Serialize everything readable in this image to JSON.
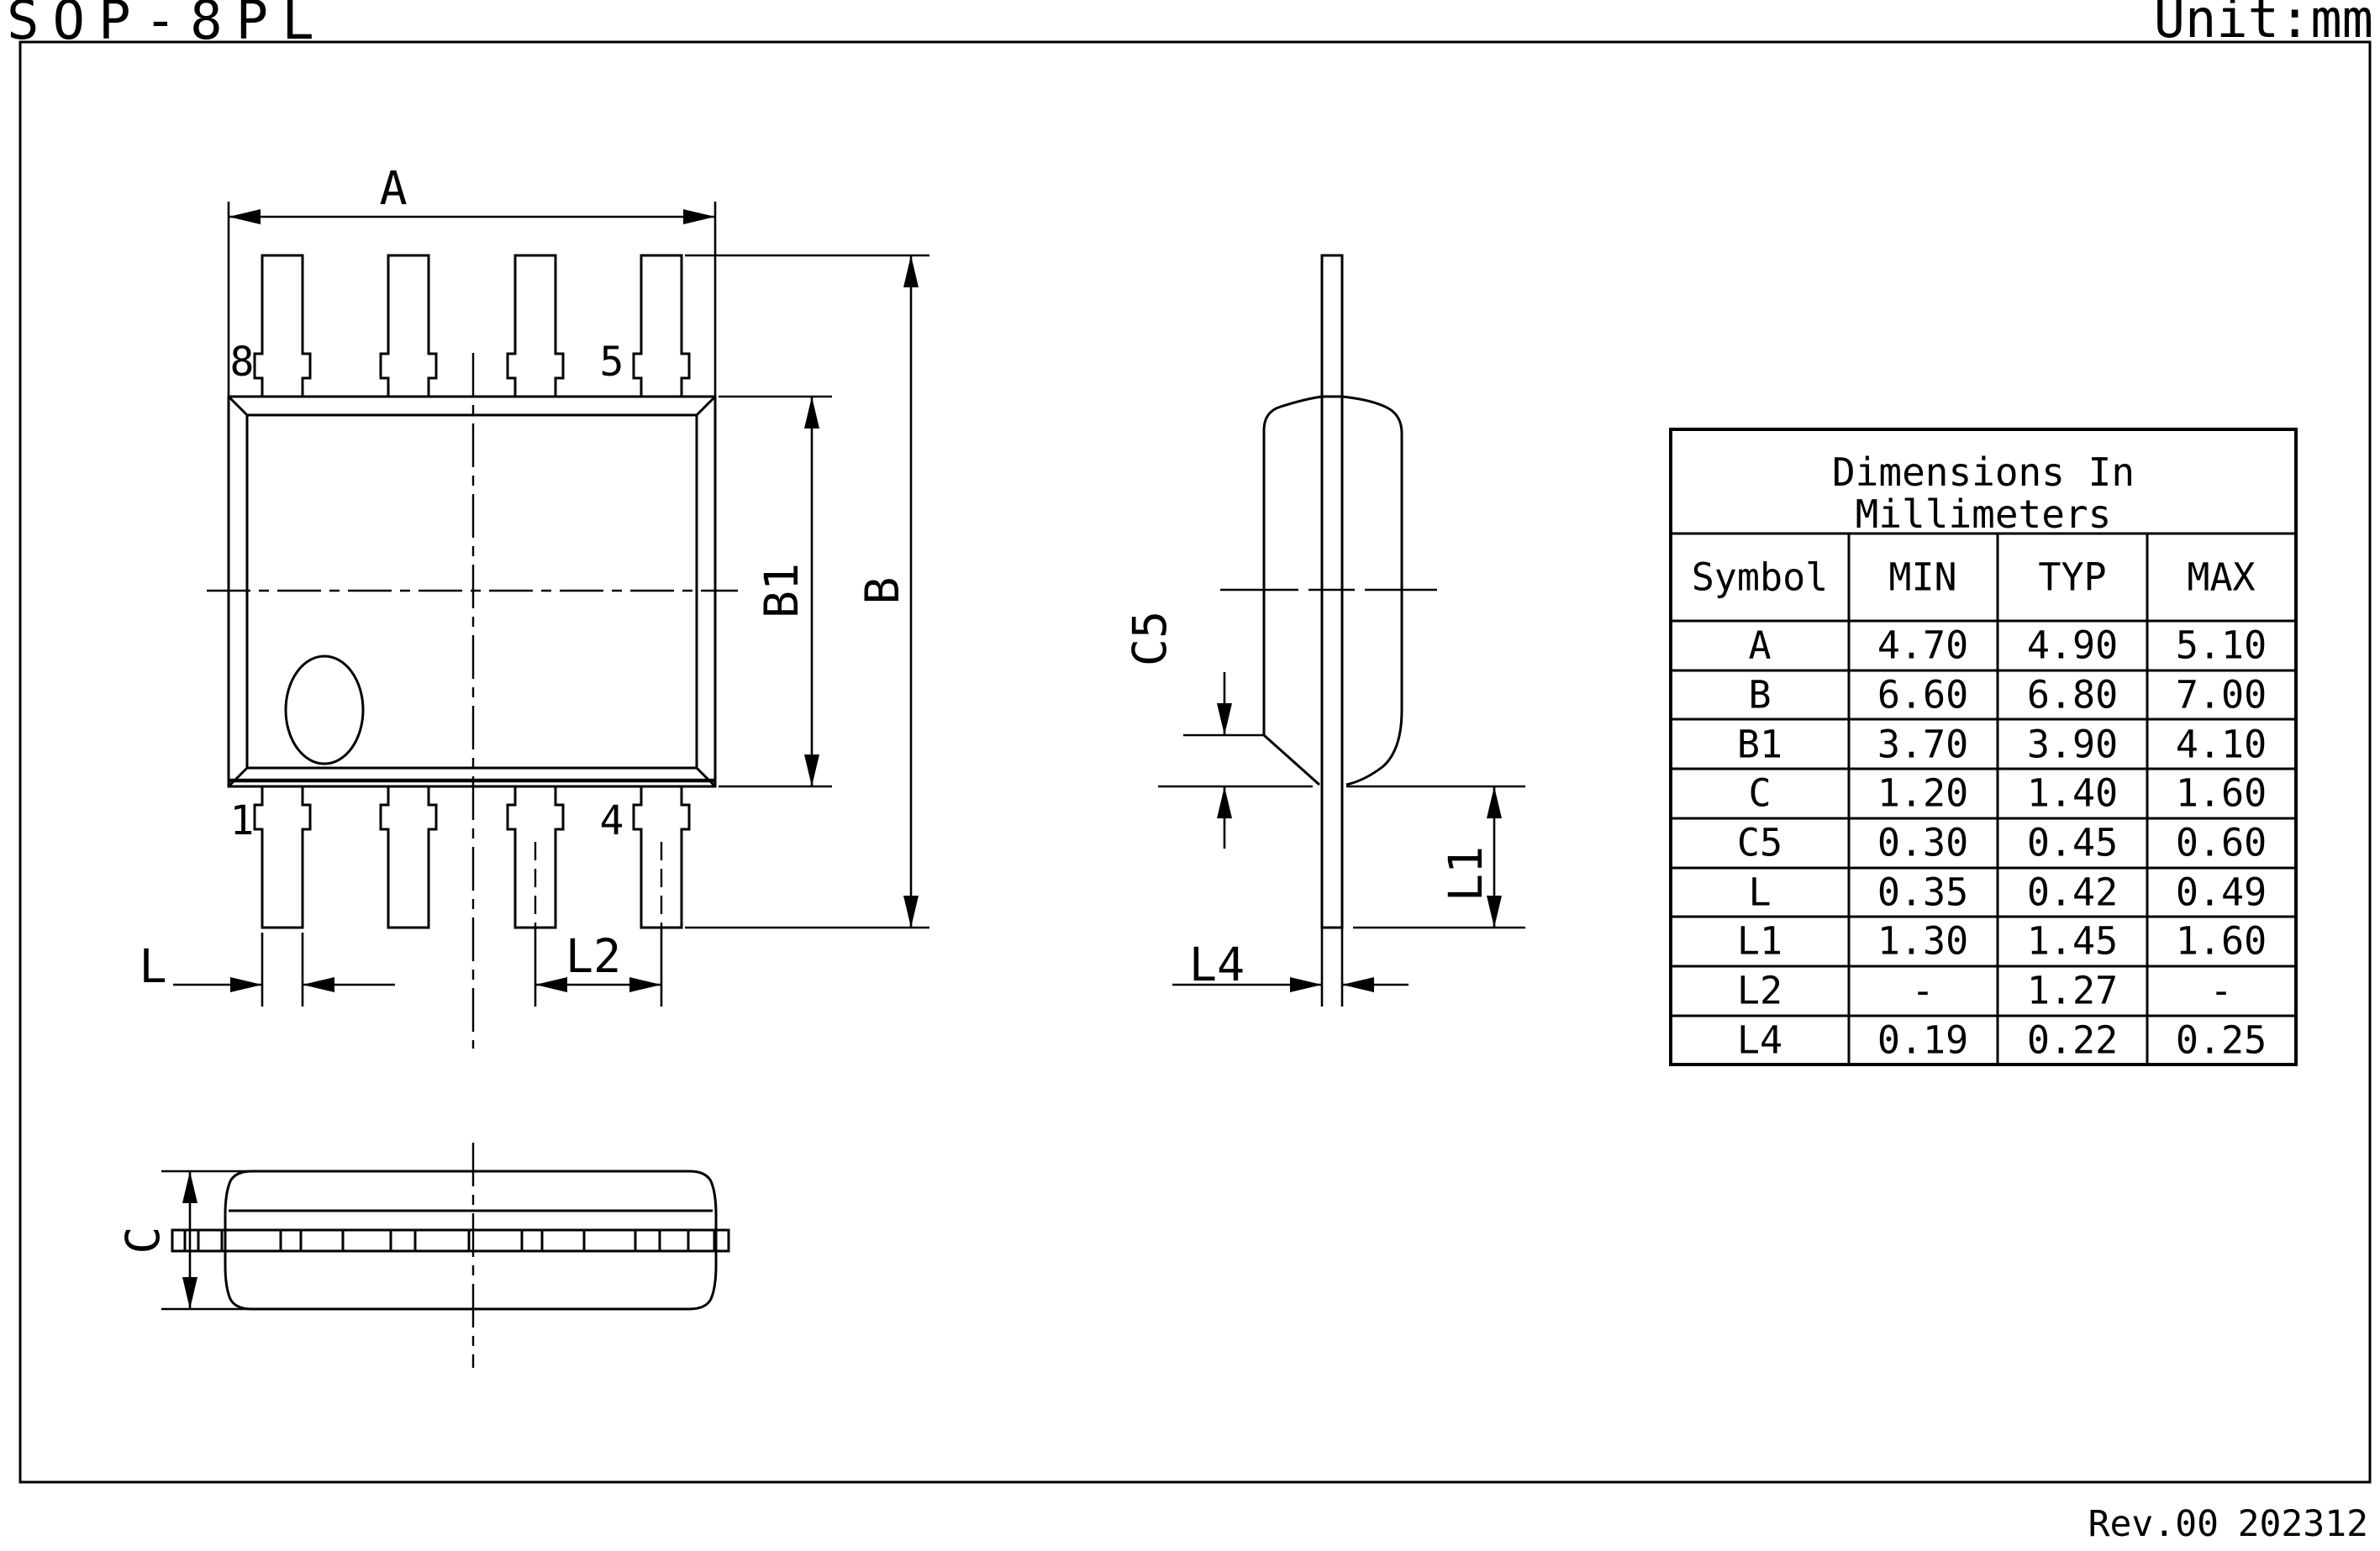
{
  "title": "SOP-8PL",
  "unit_label": "Unit:mm",
  "footer": {
    "revision": "Rev.00",
    "date": "202312"
  },
  "dim_labels": {
    "A": "A",
    "B": "B",
    "B1": "B1",
    "C": "C",
    "C5": "C5",
    "L": "L",
    "L1": "L1",
    "L2": "L2",
    "L4": "L4"
  },
  "pin_labels": {
    "pin8": "8",
    "pin5": "5",
    "pin1": "1",
    "pin4": "4"
  },
  "table": {
    "title_line1": "Dimensions In",
    "title_line2": "Millimeters",
    "columns": [
      "Symbol",
      "MIN",
      "TYP",
      "MAX"
    ],
    "rows": [
      {
        "symbol": "A",
        "min": "4.70",
        "typ": "4.90",
        "max": "5.10"
      },
      {
        "symbol": "B",
        "min": "6.60",
        "typ": "6.80",
        "max": "7.00"
      },
      {
        "symbol": "B1",
        "min": "3.70",
        "typ": "3.90",
        "max": "4.10"
      },
      {
        "symbol": "C",
        "min": "1.20",
        "typ": "1.40",
        "max": "1.60"
      },
      {
        "symbol": "C5",
        "min": "0.30",
        "typ": "0.45",
        "max": "0.60"
      },
      {
        "symbol": "L",
        "min": "0.35",
        "typ": "0.42",
        "max": "0.49"
      },
      {
        "symbol": "L1",
        "min": "1.30",
        "typ": "1.45",
        "max": "1.60"
      },
      {
        "symbol": "L2",
        "min": "-",
        "typ": "1.27",
        "max": "-"
      },
      {
        "symbol": "L4",
        "min": "0.19",
        "typ": "0.22",
        "max": "0.25"
      }
    ]
  },
  "colors": {
    "ink": "#000000",
    "paper": "#ffffff"
  }
}
